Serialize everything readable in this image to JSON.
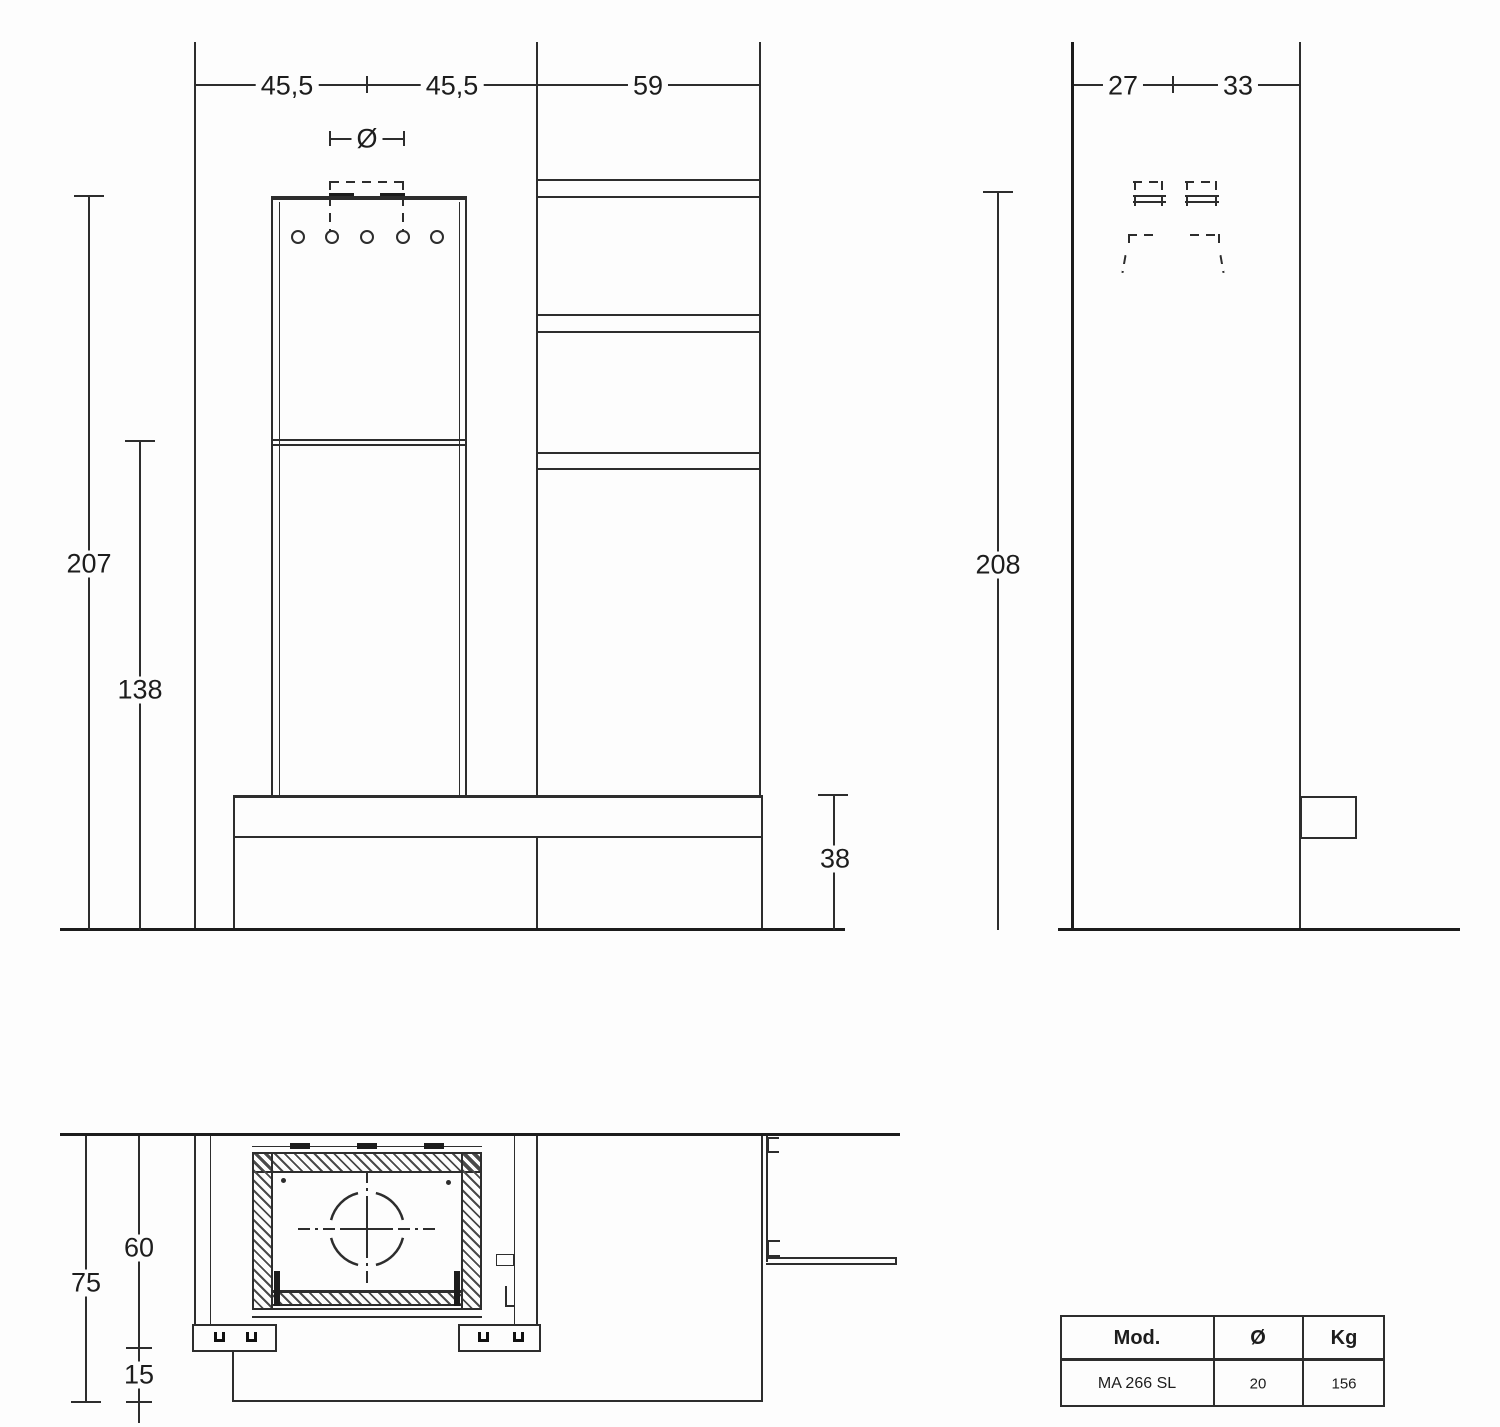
{
  "drawing": {
    "line_color": "#2d2d2d",
    "text_color": "#1d1d1d",
    "background": "#fdfdfd"
  },
  "front_view": {
    "dim_width_left": "45,5",
    "dim_width_right": "45,5",
    "dim_column_width": "59",
    "dim_flue_diameter": "Ø",
    "dim_total_height": "207",
    "dim_opening_height": "138",
    "dim_bench_height": "38"
  },
  "side_view": {
    "dim_depth_front": "27",
    "dim_depth_back": "33",
    "dim_total_height": "208"
  },
  "plan_view": {
    "dim_depth_total": "75",
    "dim_depth_firebox": "60",
    "dim_ledge": "15"
  },
  "spec_table": {
    "headers": [
      "Mod.",
      "Ø",
      "Kg"
    ],
    "row": [
      "MA 266 SL",
      "20",
      "156"
    ]
  }
}
